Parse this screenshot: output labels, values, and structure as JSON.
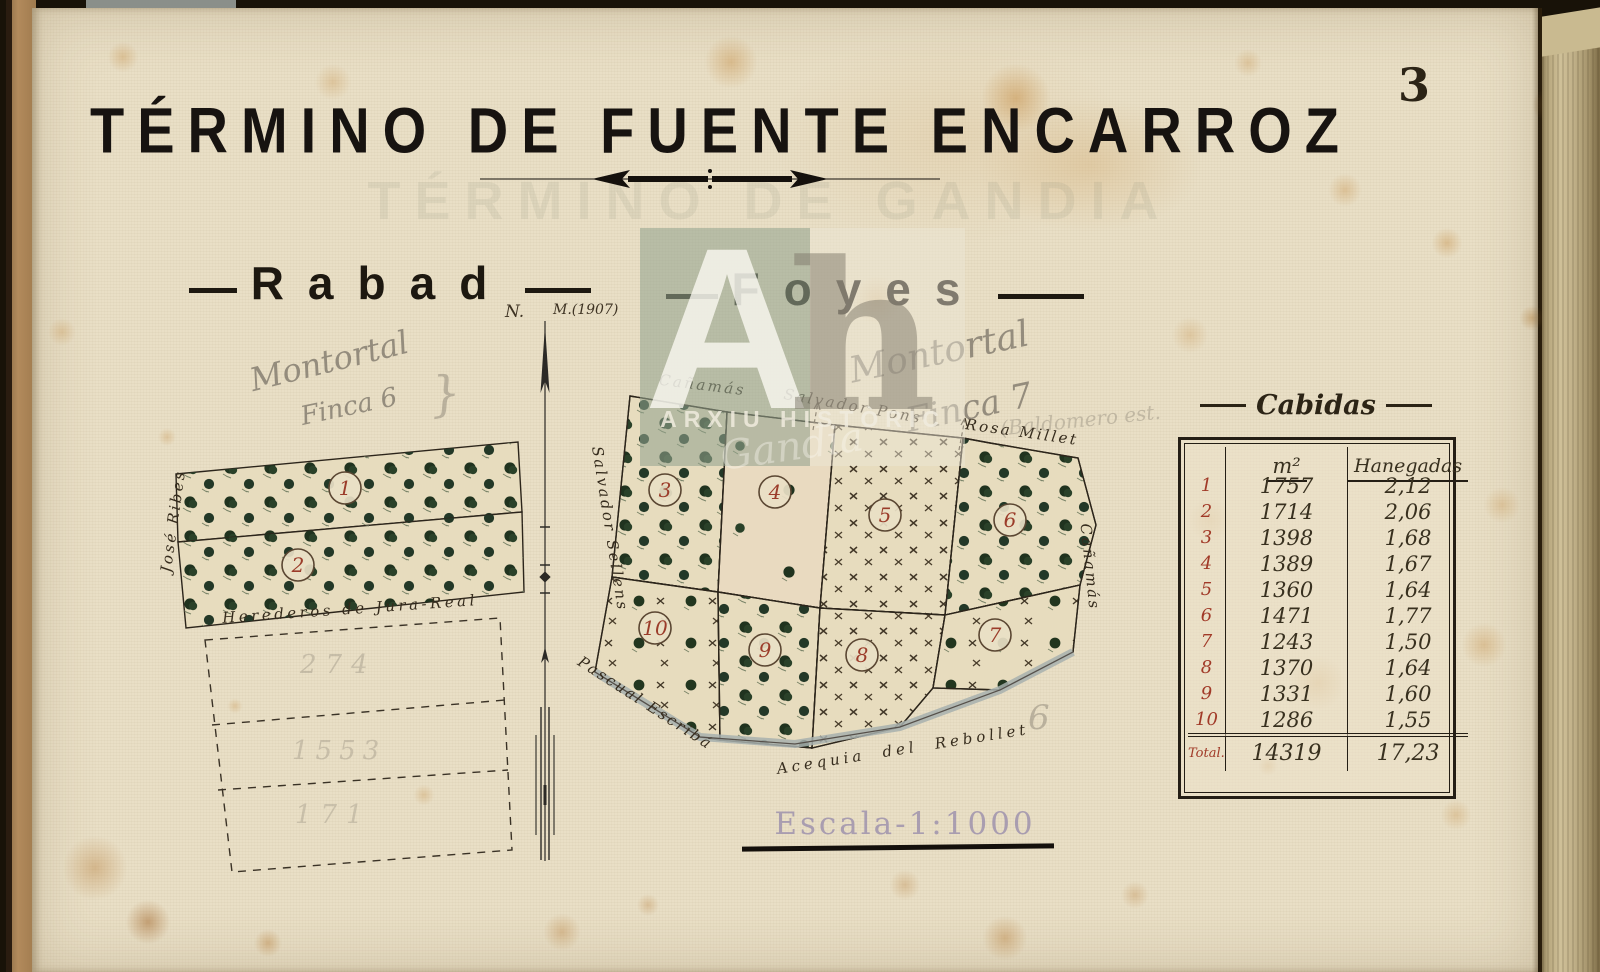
{
  "page": {
    "number": "3",
    "title": "TÉRMINO DE FUENTE ENCARROZ",
    "ghost_title": "TÉRMINO DE GANDIA",
    "scale_label": "Escala-1:1000"
  },
  "compass": {
    "north": "N.",
    "magnetic": "M.(1907)"
  },
  "sections": {
    "left": "Rabad",
    "right": "Foyes"
  },
  "rabad_map": {
    "owner_left": "José Ribes",
    "owner_bottom": "Herederos de Jura-Real",
    "parcels": [
      "1",
      "2"
    ],
    "pencil_numbers": [
      "274",
      "1553",
      "171"
    ]
  },
  "foyes_map": {
    "owner_top_left": "Cañamás",
    "owner_top_mid": "Salvador Pons",
    "owner_top_right": "Rosa Millet",
    "owner_left": "Salvador Sellens",
    "owner_bottom_left": "Pascual Escribá",
    "waterway": "Acequia del Rebollet",
    "owner_right": "Cañamás",
    "parcels": [
      "3",
      "4",
      "5",
      "6",
      "7",
      "8",
      "9",
      "10"
    ]
  },
  "pencil_notes": {
    "left_line1": "Montortal",
    "left_line2": "Finca 6",
    "brace": "}",
    "center_line1": "Montortal",
    "center_line2": "Finca 7",
    "right_note": "(Baldomero est.",
    "map_note": "6"
  },
  "watermark": {
    "monogram_a": "A",
    "monogram_h": "h",
    "label": "ARXIU HISTÒRIC",
    "script": "Gandia"
  },
  "cabidas": {
    "title": "Cabidas",
    "col_m2": "m²",
    "col_hanegadas": "Hanegadas",
    "rows": [
      {
        "n": "1",
        "m2": "1757",
        "h": "2,12"
      },
      {
        "n": "2",
        "m2": "1714",
        "h": "2,06"
      },
      {
        "n": "3",
        "m2": "1398",
        "h": "1,68"
      },
      {
        "n": "4",
        "m2": "1389",
        "h": "1,67"
      },
      {
        "n": "5",
        "m2": "1360",
        "h": "1,64"
      },
      {
        "n": "6",
        "m2": "1471",
        "h": "1,77"
      },
      {
        "n": "7",
        "m2": "1243",
        "h": "1,50"
      },
      {
        "n": "8",
        "m2": "1370",
        "h": "1,64"
      },
      {
        "n": "9",
        "m2": "1331",
        "h": "1,60"
      },
      {
        "n": "10",
        "m2": "1286",
        "h": "1,55"
      }
    ],
    "total_label": "Total.",
    "total_m2": "14319",
    "total_hanegadas": "17,23"
  }
}
